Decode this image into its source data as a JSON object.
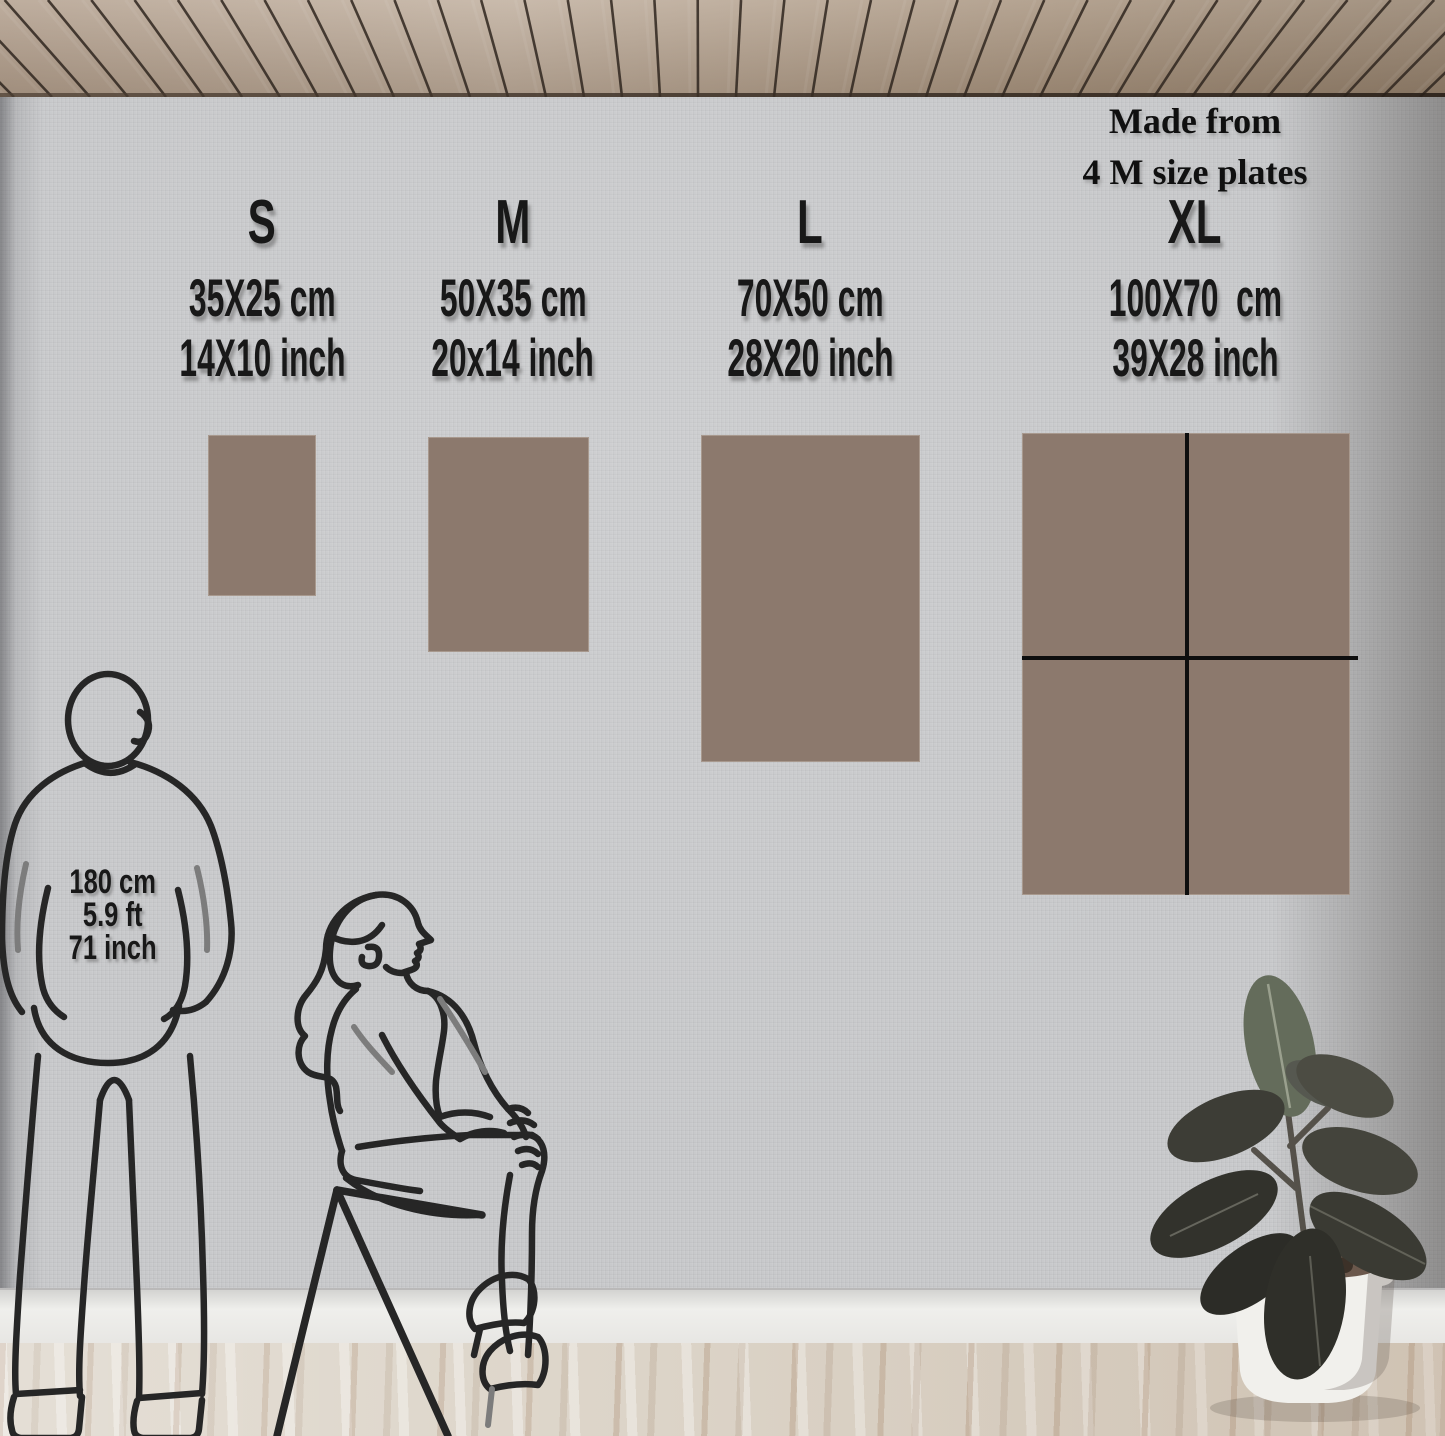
{
  "size_guide": {
    "columns": [
      {
        "id": "s",
        "label": "S",
        "cm": "35X25 cm",
        "inch": "14X10 inch"
      },
      {
        "id": "m",
        "label": "M",
        "cm": "50X35 cm",
        "inch": "20x14 inch"
      },
      {
        "id": "l",
        "label": "L",
        "cm": "70X50 cm",
        "inch": "28X20 inch"
      },
      {
        "id": "xl",
        "label": "XL",
        "cm": "100X70  cm",
        "inch": "39X28 inch"
      }
    ],
    "xl_note": {
      "line1": "Made from",
      "line2": "4 M size plates"
    }
  },
  "person_height": {
    "cm": "180 cm",
    "ft": "5.9 ft",
    "inch": "71 inch"
  },
  "colors": {
    "panel": "#8c796d",
    "panel_divider": "#0e0e0e",
    "line_art": "#262626",
    "line_art_accent": "#7c7c7c",
    "wall": "#c8c9cb",
    "ceiling_wood": "#ab9785",
    "floor_wood": "#dcd4c8",
    "baseboard": "#efefec",
    "pot": "#f1f0ec",
    "leaf_dark": "#2e2e28",
    "leaf_light": "#646c5b"
  }
}
